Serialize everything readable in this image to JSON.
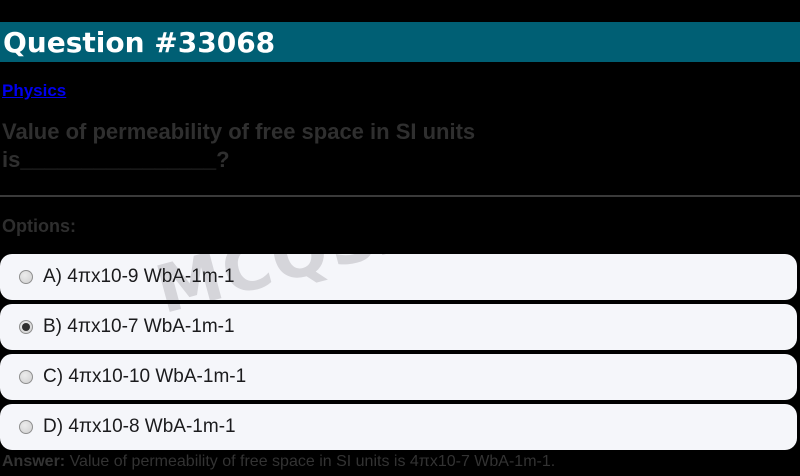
{
  "header": {
    "title": "Question #33068"
  },
  "category_link": {
    "label": "Physics"
  },
  "question": {
    "line1": "Value of permeability of free space in SI units",
    "line2": "is________________?"
  },
  "options_section": {
    "label": "Options:"
  },
  "options": [
    {
      "id": "A",
      "label": "A) 4πx10-9 WbA-1m-1",
      "selected": false
    },
    {
      "id": "B",
      "label": "B) 4πx10-7 WbA-1m-1",
      "selected": true
    },
    {
      "id": "C",
      "label": "C) 4πx10-10 WbA-1m-1",
      "selected": false
    },
    {
      "id": "D",
      "label": "D) 4πx10-8 WbA-1m-1",
      "selected": false
    }
  ],
  "answer": {
    "label": "Answer:",
    "text": " Value of permeability of free space in SI units is 4πx10-7 WbA-1m-1."
  },
  "watermark": {
    "text": "MCQSA"
  },
  "colors": {
    "header_bg": "#005f74",
    "page_bg": "#000000",
    "link_blue": "#0000ee",
    "card_bg": "#f5f6fa",
    "question_text": "#2f2f2f",
    "answer_text": "#333333",
    "watermark": "#d5d5da",
    "radio_selected_dot": "#2f2f2f"
  }
}
